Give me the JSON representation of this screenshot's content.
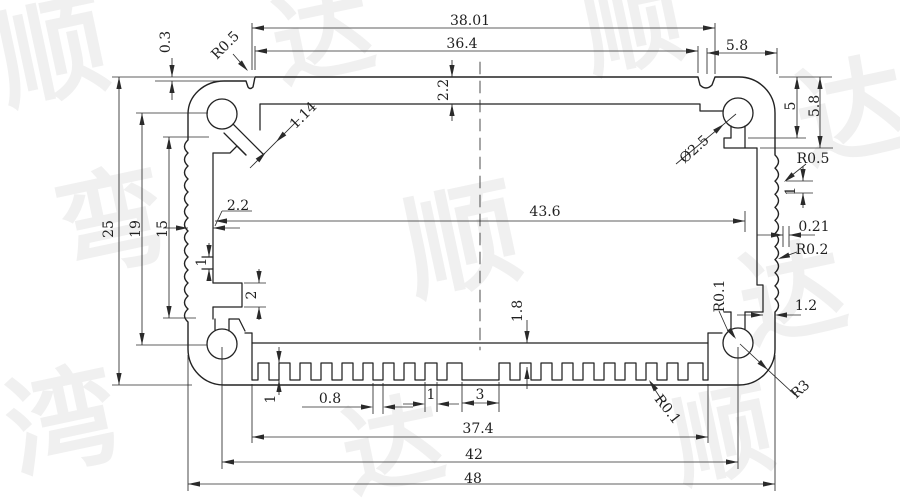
{
  "drawing": {
    "background": "#ffffff",
    "line_color": "#222222",
    "dim_text_color": "#1f1f1f",
    "watermark": {
      "text": "顺达",
      "color": "#e4e4e4",
      "glyphs": [
        {
          "ch": "顺",
          "x": 60,
          "y": 90,
          "rot": -12,
          "size": 110
        },
        {
          "ch": "达",
          "x": 330,
          "y": 70,
          "rot": -12,
          "size": 100
        },
        {
          "ch": "顺",
          "x": 640,
          "y": 60,
          "rot": -12,
          "size": 100
        },
        {
          "ch": "达",
          "x": 860,
          "y": 150,
          "rot": -12,
          "size": 110
        },
        {
          "ch": "弯",
          "x": 120,
          "y": 260,
          "rot": -12,
          "size": 110
        },
        {
          "ch": "顺",
          "x": 470,
          "y": 280,
          "rot": -12,
          "size": 115
        },
        {
          "ch": "达",
          "x": 800,
          "y": 330,
          "rot": -12,
          "size": 105
        },
        {
          "ch": "湾",
          "x": 70,
          "y": 460,
          "rot": -12,
          "size": 110
        },
        {
          "ch": "达",
          "x": 400,
          "y": 480,
          "rot": -12,
          "size": 100
        },
        {
          "ch": "顺",
          "x": 730,
          "y": 470,
          "rot": -12,
          "size": 100
        }
      ]
    },
    "dimensions": [
      {
        "label": "38.01",
        "x": 470,
        "y": 20,
        "rot": 0
      },
      {
        "label": "36.4",
        "x": 462,
        "y": 43,
        "rot": 0
      },
      {
        "label": "5.8",
        "x": 737,
        "y": 45,
        "rot": 0
      },
      {
        "label": "0.3",
        "x": 165,
        "y": 42,
        "rot": -90
      },
      {
        "label": "R0.5",
        "x": 225,
        "y": 45,
        "rot": -45
      },
      {
        "label": "1.14",
        "x": 303,
        "y": 115,
        "rot": -45
      },
      {
        "label": "2.2",
        "x": 443,
        "y": 90,
        "rot": -90
      },
      {
        "label": "Ø2.5",
        "x": 694,
        "y": 149,
        "rot": -42
      },
      {
        "label": "5",
        "x": 790,
        "y": 106,
        "rot": -90
      },
      {
        "label": "5.8",
        "x": 814,
        "y": 106,
        "rot": -90
      },
      {
        "label": "R0.5",
        "x": 813,
        "y": 158,
        "rot": 0
      },
      {
        "label": "1",
        "x": 790,
        "y": 191,
        "rot": -90
      },
      {
        "label": "0.21",
        "x": 814,
        "y": 226,
        "rot": 0
      },
      {
        "label": "R0.2",
        "x": 812,
        "y": 249,
        "rot": 0
      },
      {
        "label": "43.6",
        "x": 545,
        "y": 211,
        "rot": 0
      },
      {
        "label": "2.2",
        "x": 238,
        "y": 205,
        "rot": 0
      },
      {
        "label": "25",
        "x": 108,
        "y": 229,
        "rot": -90
      },
      {
        "label": "19",
        "x": 135,
        "y": 229,
        "rot": -90
      },
      {
        "label": "15",
        "x": 162,
        "y": 229,
        "rot": -90
      },
      {
        "label": "1",
        "x": 201,
        "y": 262,
        "rot": -90
      },
      {
        "label": "2",
        "x": 251,
        "y": 295,
        "rot": -90
      },
      {
        "label": "1.8",
        "x": 517,
        "y": 311,
        "rot": -90
      },
      {
        "label": "R0.1",
        "x": 719,
        "y": 296,
        "rot": -90
      },
      {
        "label": "1.2",
        "x": 806,
        "y": 305,
        "rot": 0
      },
      {
        "label": "R3",
        "x": 800,
        "y": 389,
        "rot": -42
      },
      {
        "label": "R0.1",
        "x": 668,
        "y": 409,
        "rot": 52
      },
      {
        "label": "1",
        "x": 270,
        "y": 399,
        "rot": -90
      },
      {
        "label": "0.8",
        "x": 330,
        "y": 398,
        "rot": 0
      },
      {
        "label": "1",
        "x": 431,
        "y": 394,
        "rot": 0
      },
      {
        "label": "3",
        "x": 480,
        "y": 394,
        "rot": 0
      },
      {
        "label": "37.4",
        "x": 478,
        "y": 428,
        "rot": 0
      },
      {
        "label": "42",
        "x": 474,
        "y": 454,
        "rot": 0
      },
      {
        "label": "48",
        "x": 473,
        "y": 478,
        "rot": 0
      }
    ]
  }
}
